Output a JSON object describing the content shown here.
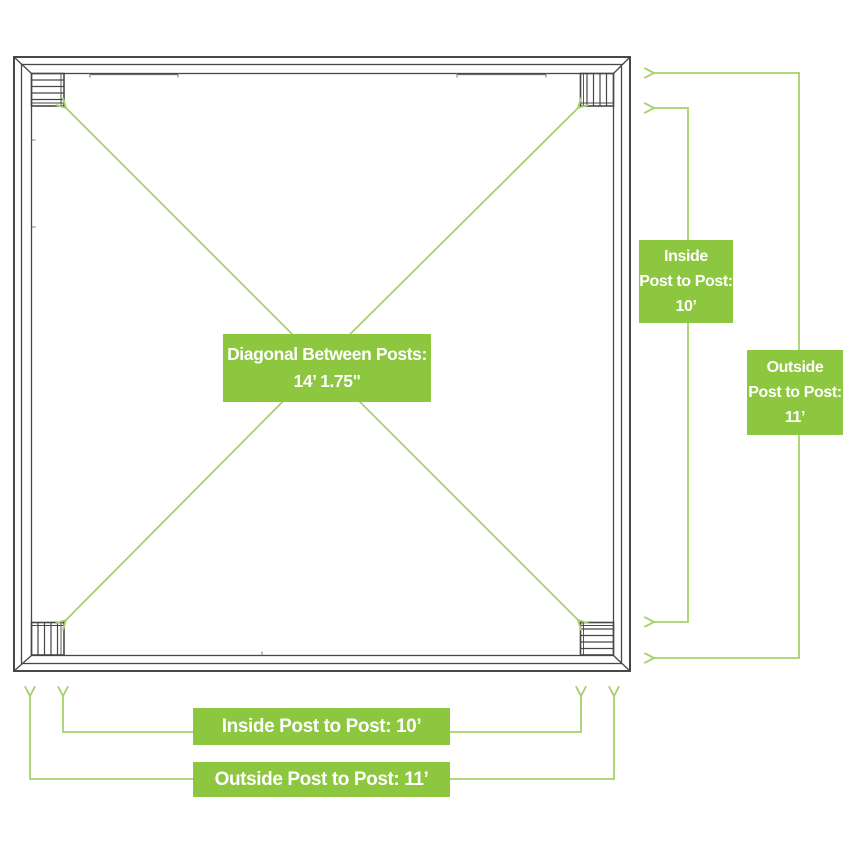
{
  "colors": {
    "box_green": "#8dc63f",
    "line_green": "#a5d16c",
    "frame_gray": "#474747",
    "text_white": "#ffffff",
    "background": "#ffffff"
  },
  "diagram": {
    "type": "pergola-post-layout-top-view",
    "posts_count": 4,
    "center_label": {
      "line1": "Diagonal Between Posts:",
      "line2": "14’ 1.75\""
    },
    "side_labels": {
      "inside": {
        "line1": "Inside",
        "line2": "Post to Post:",
        "line3": "10’"
      },
      "outside": {
        "line1": "Outside",
        "line2": "Post to Post:",
        "line3": "11’"
      }
    },
    "bottom_labels": {
      "inside": "Inside Post to Post: 10’",
      "outside": "Outside Post to Post: 11’"
    },
    "measurements": {
      "diagonal_between_posts": "14’ 1.75\"",
      "inside_post_to_post": "10’",
      "outside_post_to_post": "11’"
    }
  }
}
